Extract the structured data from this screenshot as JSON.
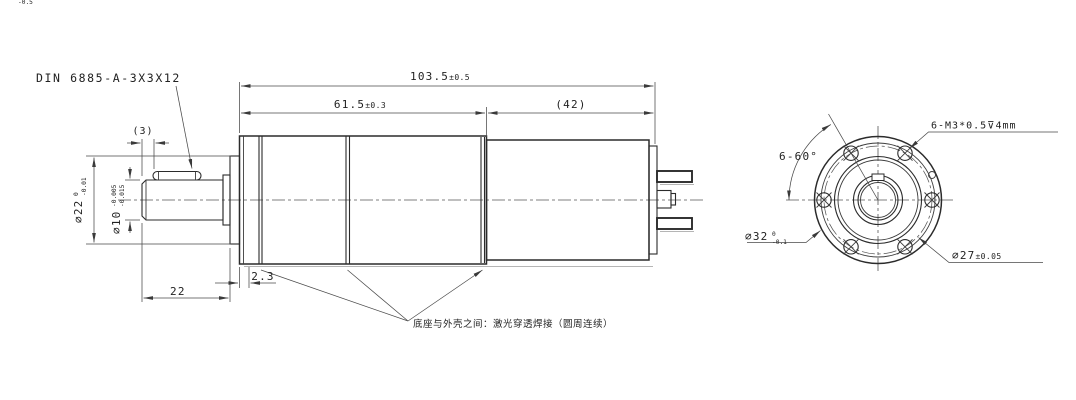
{
  "labels": {
    "key_spec": "DIN 6885-A-3X3X12",
    "weld_note": "底座与外壳之间：激光穿透焊接（圆周连续）",
    "tap_spec": "6-M3*0.5⊽4mm",
    "hole_pattern_angle": "6-60°"
  },
  "dims": {
    "total_len": {
      "value": "103.5",
      "tol": "±0.5"
    },
    "gearbox_len": {
      "value": "61.5",
      "tol": "±0.3"
    },
    "motor_len": {
      "value": "(42)"
    },
    "key_pos": {
      "value": "(3)"
    },
    "boss_dia": {
      "value": "⌀22",
      "upper": "0",
      "lower": "-0.01"
    },
    "shaft_dia": {
      "value": "⌀10",
      "upper": "-0.005",
      "lower": "-0.015"
    },
    "shaft_len": {
      "value": "22",
      "upper": "0",
      "lower": "-0.5"
    },
    "plate_thk": {
      "value": "2.3"
    },
    "flange_dia": {
      "value": "⌀32",
      "upper": "0",
      "lower": "-0.1"
    },
    "bolt_circle": {
      "value": "⌀27",
      "tol": "±0.05"
    }
  }
}
